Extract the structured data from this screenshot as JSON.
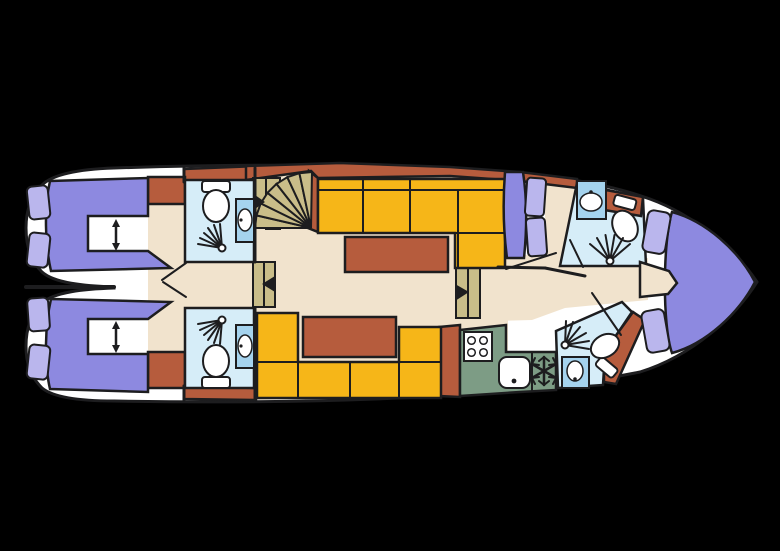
{
  "colors": {
    "background": "#000000",
    "outline": "#1d1d1f",
    "hull_white": "#ffffff",
    "floor_cream": "#f1e3cd",
    "cabinet_rust": "#b65c3d",
    "sofa_yellow": "#f6b618",
    "stair_tan": "#c9bd89",
    "bed_purple": "#8d89e0",
    "pillow_lilac": "#bab6ed",
    "bath_blue": "#d6edf8",
    "sink_blue": "#a5d3ee",
    "galley_green": "#7d9c85",
    "fixture_white": "#ffffff"
  },
  "plan": {
    "type": "boat-deck-floor-plan",
    "rooms": [
      "aft-cabin-port",
      "aft-cabin-starboard",
      "aft-bathroom-port",
      "aft-bathroom-starboard",
      "saloon",
      "galley",
      "mid-berth",
      "bow-bathroom-port",
      "bow-bathroom-starboard",
      "bow-cabin"
    ],
    "fixtures": [
      "toilet-icon",
      "washbasin-icon",
      "shower-icon",
      "stove-icon",
      "sink-icon",
      "snowflake-fridge-icon",
      "spiral-stairs-icon",
      "companionway-steps-icon",
      "double-arrow-icon",
      "berth-icon",
      "sofa-icon",
      "table-icon"
    ]
  }
}
